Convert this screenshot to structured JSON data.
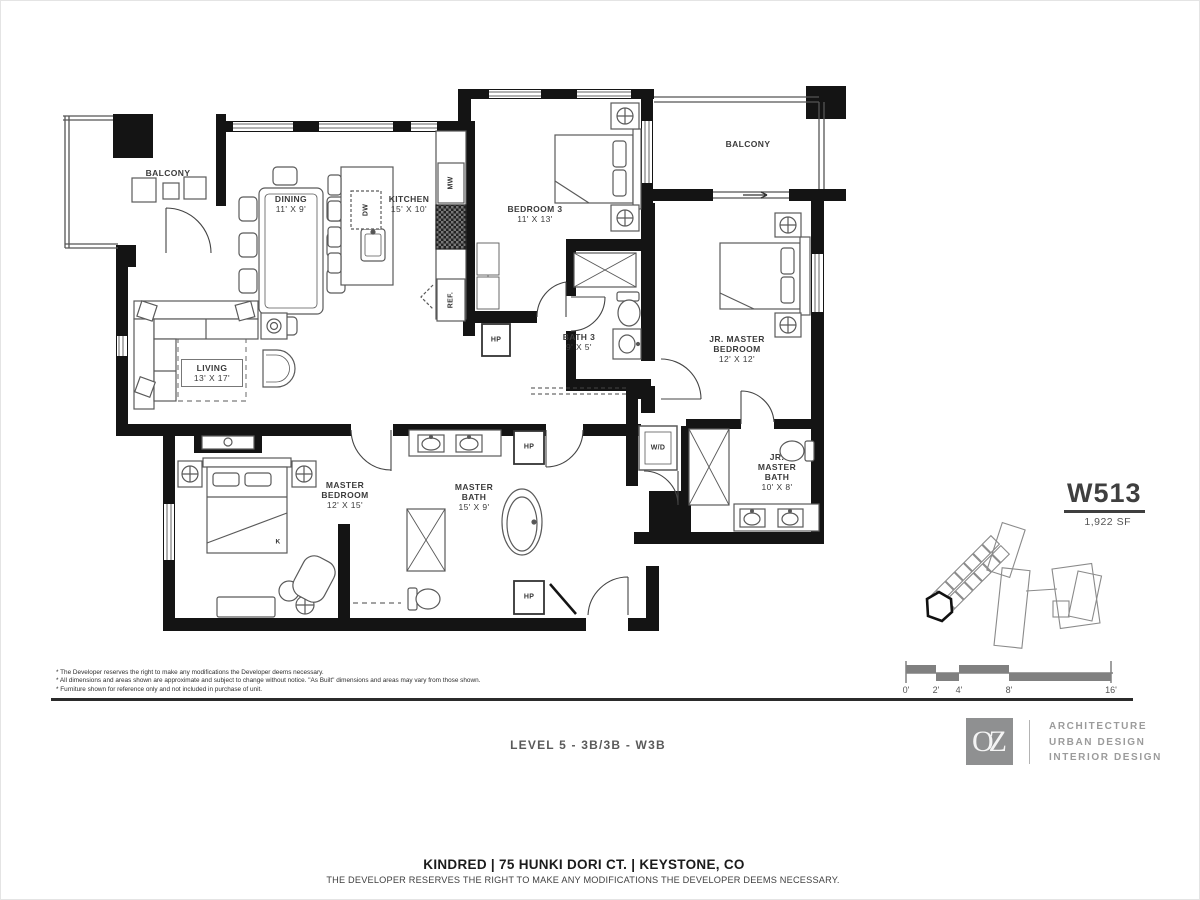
{
  "unit": {
    "number": "W513",
    "area": "1,922 SF"
  },
  "plan": {
    "rooms": {
      "balcony_left": {
        "name": "BALCONY",
        "dims": ""
      },
      "balcony_right": {
        "name": "BALCONY",
        "dims": ""
      },
      "dining": {
        "name": "DINING",
        "dims": "11' X 9'"
      },
      "kitchen": {
        "name": "KITCHEN",
        "dims": "15' X 10'"
      },
      "bedroom3": {
        "name": "BEDROOM 3",
        "dims": "11' X 13'"
      },
      "bath3": {
        "name": "BATH 3",
        "dims": "9' X 5'"
      },
      "living": {
        "name": "LIVING",
        "dims": "13' X 17'"
      },
      "master_bedroom": {
        "name": "MASTER BEDROOM",
        "dims": "12' X 15'"
      },
      "master_bath": {
        "name": "MASTER BATH",
        "dims": "15' X 9'"
      },
      "jr_master_bedroom": {
        "name": "JR. MASTER BEDROOM",
        "dims": "12' X 12'"
      },
      "jr_master_bath": {
        "name": "JR. MASTER BATH",
        "dims": "10' X 8'"
      }
    },
    "fixtures": {
      "dw": "DW",
      "mw": "MW",
      "ref": "REF.",
      "wd": "W/D",
      "hp": "HP",
      "king_bed": "K"
    }
  },
  "scale_bar": {
    "ticks": [
      "0'",
      "2'",
      "4'",
      "8'",
      "16'"
    ]
  },
  "brand": {
    "logo_text": "OZ",
    "services": [
      "ARCHITECTURE",
      "URBAN DESIGN",
      "INTERIOR DESIGN"
    ]
  },
  "captions": {
    "level": "LEVEL 5 - 3B/3B - W3B"
  },
  "notes": [
    "* The Developer reserves the right to make any modifications the Developer deems necessary.",
    "* All dimensions and areas shown are approximate and subject to change without notice. \"As Built\" dimensions and areas may vary from those shown.",
    "* Furniture shown for reference only and not included in purchase of unit."
  ],
  "footer": {
    "address": "KINDRED | 75 HUNKI DORI CT. | KEYSTONE, CO",
    "disclaimer": "THE DEVELOPER RESERVES THE RIGHT TO MAKE ANY MODIFICATIONS THE DEVELOPER DEEMS NECESSARY."
  },
  "colors": {
    "wall": "#141414",
    "logo_gray": "#8f9091",
    "label": "#3b3b3b",
    "scale_gray": "#808080"
  }
}
